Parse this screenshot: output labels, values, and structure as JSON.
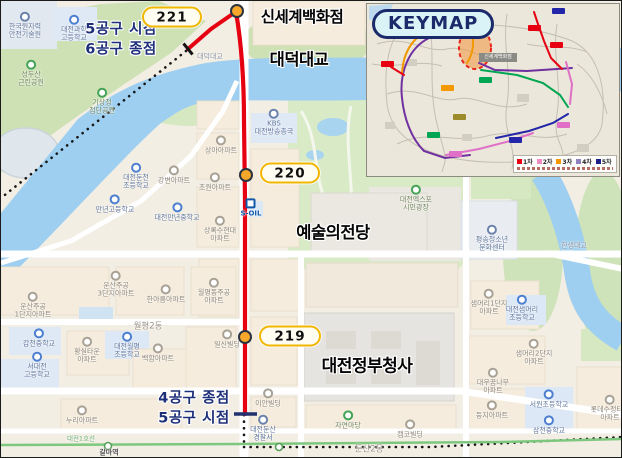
{
  "colors": {
    "route_red": "#e60112",
    "marker_fill": "#f7a82a",
    "badge_border": "#f2b600",
    "section_navy": "#1e2f7a",
    "metro_green": "#7dc87e"
  },
  "stations": [
    {
      "label": "221",
      "badge": {
        "x": 171,
        "y": 16,
        "w": 60,
        "h": 21
      },
      "marker": {
        "x": 236,
        "y": 10
      }
    },
    {
      "label": "220",
      "badge": {
        "x": 289,
        "y": 172,
        "w": 60,
        "h": 21
      },
      "marker": {
        "x": 245,
        "y": 174
      }
    },
    {
      "label": "219",
      "badge": {
        "x": 289,
        "y": 335,
        "w": 62,
        "h": 21
      },
      "marker": {
        "x": 244,
        "y": 336
      }
    }
  ],
  "major_labels": [
    {
      "text": "신세계백화점",
      "x": 301,
      "y": 15,
      "size": 15.5
    },
    {
      "text": "대덕대교",
      "x": 298,
      "y": 57,
      "size": 16.5
    },
    {
      "text": "예술의전당",
      "x": 332,
      "y": 230,
      "size": 16.5
    },
    {
      "text": "대전정부청사",
      "x": 366,
      "y": 363,
      "size": 17
    }
  ],
  "section_labels": [
    {
      "lines": [
        "5공구 시점",
        "6공구 종점"
      ],
      "x": 120,
      "y": 39
    },
    {
      "lines": [
        "4공구 종점",
        "5공구 시점"
      ],
      "x": 193,
      "y": 408
    }
  ],
  "keymap": {
    "title": "KEYMAP",
    "callout": "신세계백화점",
    "legend": [
      {
        "label": "1차",
        "color": "#e60012"
      },
      {
        "label": "2차",
        "color": "#ef8bc0"
      },
      {
        "label": "3차",
        "color": "#f39800"
      },
      {
        "label": "4차",
        "color": "#8f82bc"
      },
      {
        "label": "5차",
        "color": "#1d2088"
      }
    ]
  },
  "map_labels": [
    {
      "text": "한국원자력\n안전기술원",
      "x": 24,
      "y": 26,
      "type": "public"
    },
    {
      "text": "대전과학\n고등학교",
      "x": 73,
      "y": 29,
      "type": "school"
    },
    {
      "text": "성두산\n근린공원",
      "x": 30,
      "y": 74,
      "type": "park"
    },
    {
      "text": "기상청\n첨단공원",
      "x": 101,
      "y": 102,
      "type": "park"
    },
    {
      "text": "대전둔천\n초등학교",
      "x": 135,
      "y": 177,
      "type": "school"
    },
    {
      "text": "강변아파트",
      "x": 173,
      "y": 175,
      "type": "apt"
    },
    {
      "text": "만년고등학교",
      "x": 114,
      "y": 204,
      "type": "school"
    },
    {
      "text": "대전만년중학교",
      "x": 176,
      "y": 212,
      "type": "school"
    },
    {
      "text": "상아아파트",
      "x": 220,
      "y": 145,
      "type": "apt"
    },
    {
      "text": "초원아파트",
      "x": 214,
      "y": 182,
      "type": "apt"
    },
    {
      "text": "상록수현대\n아파트",
      "x": 219,
      "y": 230,
      "type": "apt"
    },
    {
      "text": "S-OIL",
      "x": 250,
      "y": 208,
      "type": "oil"
    },
    {
      "text": "KBS\n대전방송총국",
      "x": 273,
      "y": 123,
      "type": "public"
    },
    {
      "text": "운산주공\n3단지아파트",
      "x": 115,
      "y": 285,
      "type": "apt"
    },
    {
      "text": "한아름아파트",
      "x": 165,
      "y": 294,
      "type": "apt"
    },
    {
      "text": "월평동주공\n아파트",
      "x": 213,
      "y": 292,
      "type": "apt"
    },
    {
      "text": "운산주공\n1단지아파트",
      "x": 32,
      "y": 306,
      "type": "apt"
    },
    {
      "text": "월평2동",
      "x": 147,
      "y": 326,
      "type": "admin"
    },
    {
      "text": "갑천중학교",
      "x": 38,
      "y": 338,
      "type": "school"
    },
    {
      "text": "황실타운\n아파트",
      "x": 86,
      "y": 351,
      "type": "apt"
    },
    {
      "text": "대전월평\n초등학교",
      "x": 126,
      "y": 346,
      "type": "school"
    },
    {
      "text": "서대전\n고등학교",
      "x": 36,
      "y": 366,
      "type": "school"
    },
    {
      "text": "누리아파트",
      "x": 81,
      "y": 415,
      "type": "apt"
    },
    {
      "text": "백합아파트",
      "x": 157,
      "y": 353,
      "type": "apt"
    },
    {
      "text": "일신빌딩",
      "x": 226,
      "y": 339,
      "type": "place"
    },
    {
      "text": "이안빌딩",
      "x": 267,
      "y": 398,
      "type": "place"
    },
    {
      "text": "대전둔산\n경찰서",
      "x": 262,
      "y": 429,
      "type": "public"
    },
    {
      "text": "자연마당",
      "x": 347,
      "y": 420,
      "type": "park"
    },
    {
      "text": "캠코빌딩",
      "x": 409,
      "y": 429,
      "type": "place"
    },
    {
      "text": "둔산2동",
      "x": 368,
      "y": 449,
      "type": "admin"
    },
    {
      "text": "샘머리2단지\n아파트",
      "x": 533,
      "y": 353,
      "type": "apt"
    },
    {
      "text": "대우꿈나무\n아파트",
      "x": 492,
      "y": 382,
      "type": "apt"
    },
    {
      "text": "둥지아파트",
      "x": 491,
      "y": 410,
      "type": "apt"
    },
    {
      "text": "서원초등학교",
      "x": 548,
      "y": 399,
      "type": "school"
    },
    {
      "text": "삼천중학교",
      "x": 548,
      "y": 425,
      "type": "school"
    },
    {
      "text": "롯데수정타운\n아파트",
      "x": 609,
      "y": 409,
      "type": "apt"
    },
    {
      "text": "샘머리1단지\n아파트",
      "x": 488,
      "y": 303,
      "type": "apt"
    },
    {
      "text": "대전샘머리\n초등학교",
      "x": 521,
      "y": 309,
      "type": "school"
    },
    {
      "text": "평송청소년\n문화센터",
      "x": 491,
      "y": 239,
      "type": "public"
    },
    {
      "text": "한샘대교",
      "x": 573,
      "y": 245,
      "type": "bridge"
    },
    {
      "text": "대전엑스포\n시민광장",
      "x": 415,
      "y": 199,
      "type": "park"
    },
    {
      "text": "대덕대교",
      "x": 209,
      "y": 56,
      "type": "bridge"
    },
    {
      "text": "갈마역",
      "x": 108,
      "y": 452,
      "type": "station"
    },
    {
      "text": "대전1호선",
      "x": 80,
      "y": 439,
      "type": "line"
    }
  ]
}
